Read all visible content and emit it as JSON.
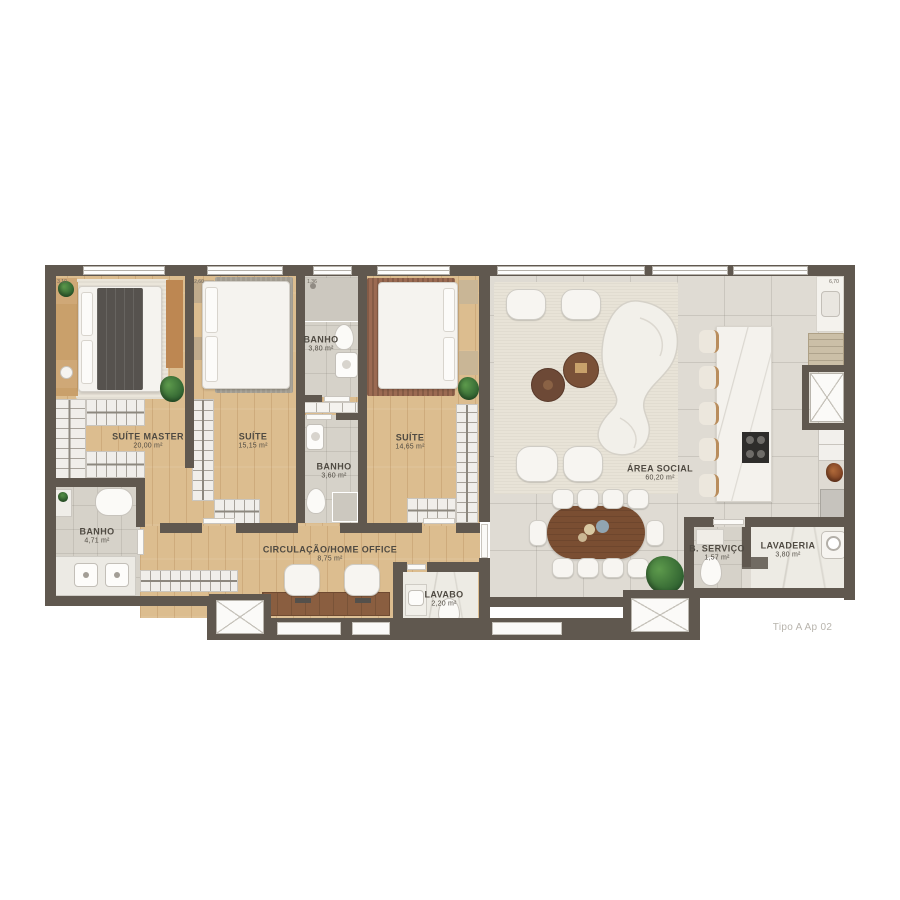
{
  "plan": {
    "signature": "Tipo A Ap 02",
    "rooms": [
      {
        "id": "suite-master",
        "name": "SUÍTE MASTER",
        "area": "20,00 m²"
      },
      {
        "id": "suite-2",
        "name": "SUÍTE",
        "area": "15,15 m²"
      },
      {
        "id": "banho-suite-2",
        "name": "BANHO",
        "area": "3,80 m²"
      },
      {
        "id": "banho-suite-3",
        "name": "BANHO",
        "area": "3,60 m²"
      },
      {
        "id": "suite-3",
        "name": "SUÍTE",
        "area": "14,65 m²"
      },
      {
        "id": "banho-master",
        "name": "BANHO",
        "area": "4,71 m²"
      },
      {
        "id": "circulacao-home-office",
        "name": "CIRCULAÇÃO/HOME OFFICE",
        "area": "8,75 m²"
      },
      {
        "id": "lavabo",
        "name": "LAVABO",
        "area": "2,20 m²"
      },
      {
        "id": "area-social",
        "name": "ÁREA SOCIAL",
        "area": "60,20 m²"
      },
      {
        "id": "b-servico",
        "name": "B. SERVIÇO",
        "area": "1,57 m²"
      },
      {
        "id": "lavaderia",
        "name": "LAVADERIA",
        "area": "3,80 m²"
      }
    ],
    "dims": [
      "3,10",
      "2,60",
      "1,36",
      "6,70"
    ],
    "colors": {
      "wall": "#60584f",
      "wood_floor": "#dcbd8f",
      "social_tile": "#dfdbd3",
      "bath_tile": "#d6d2c9",
      "table_wood": "#7a4e32",
      "plant_green": "#3f7a3c"
    }
  }
}
